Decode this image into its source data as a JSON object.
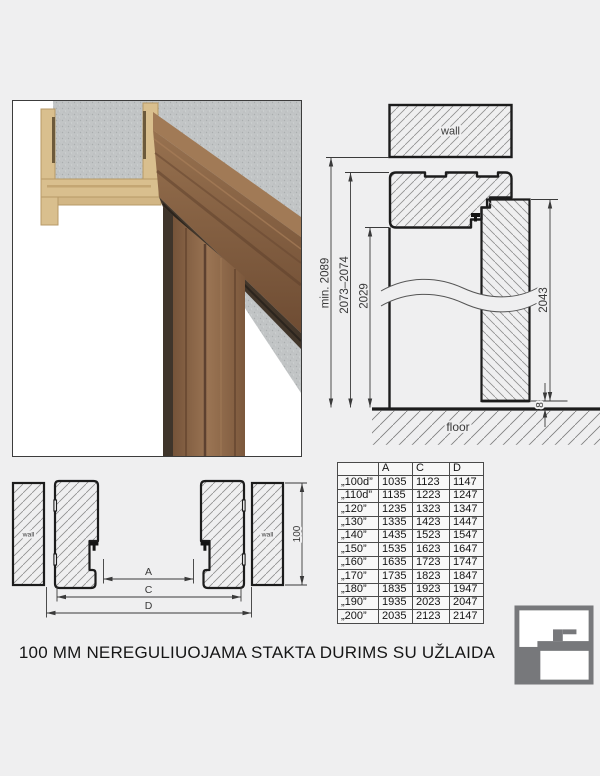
{
  "page": {
    "title": "100 MM NEREGULIUOJAMA STAKTA DURIMS SU UŽLAIDA"
  },
  "vertical_section": {
    "wall_label": "wall",
    "floor_label": "floor",
    "dimensions": {
      "total_height": "min. 2089",
      "frame_height": "2073–2074",
      "opening_height": "2029",
      "door_height": "2043",
      "floor_gap": "8"
    }
  },
  "horizontal_section": {
    "wall_left_label": "wall",
    "wall_right_label": "wall",
    "dimensions": {
      "a": "A",
      "c": "C",
      "d": "D",
      "frame_depth": "100"
    }
  },
  "table": {
    "headers": [
      "",
      "A",
      "C",
      "D"
    ],
    "rows": [
      [
        "„100d”",
        1035,
        1123,
        1147
      ],
      [
        "„110d”",
        1135,
        1223,
        1247
      ],
      [
        "„120”",
        1235,
        1323,
        1347
      ],
      [
        "„130”",
        1335,
        1423,
        1447
      ],
      [
        "„140”",
        1435,
        1523,
        1547
      ],
      [
        "„150”",
        1535,
        1623,
        1647
      ],
      [
        "„160”",
        1635,
        1723,
        1747
      ],
      [
        "„170”",
        1735,
        1823,
        1847
      ],
      [
        "„180”",
        1835,
        1923,
        1947
      ],
      [
        "„190”",
        1935,
        2023,
        2047
      ],
      [
        "„200”",
        2035,
        2123,
        2147
      ]
    ]
  },
  "colors": {
    "background": "#efeff0",
    "line": "#1c1c1c",
    "hatch": "#8f8f8f",
    "dimension": "#3a3a3a",
    "logo_gray": "#77787b",
    "wood": "#8a6547",
    "mdf": "#d9bf8e",
    "concrete": "#c2c5c6"
  }
}
